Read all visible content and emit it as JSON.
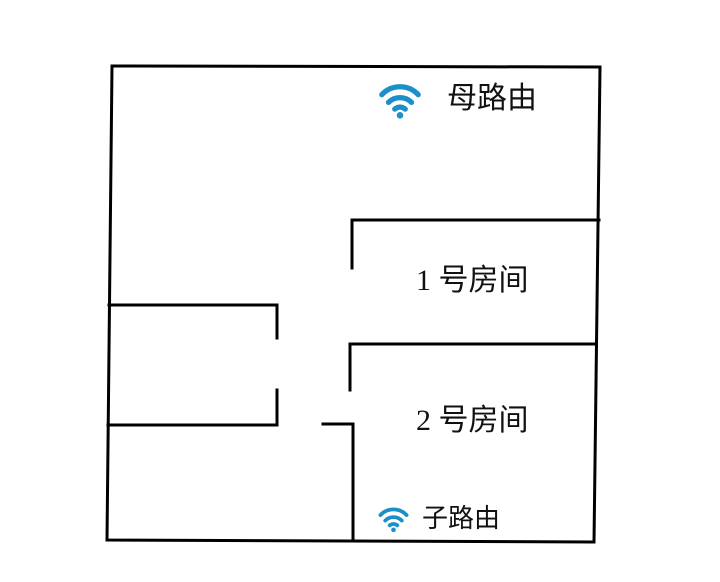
{
  "colors": {
    "wifi_blue": "#1b90c8",
    "wall_black": "#000000",
    "page_bg": "#ffffff"
  },
  "floorplan": {
    "mother_router": {
      "label": "母路由",
      "icon": "wifi-icon"
    },
    "child_router": {
      "label": "子路由",
      "icon": "wifi-icon"
    },
    "rooms": [
      {
        "label": "1 号房间"
      },
      {
        "label": "2 号房间"
      }
    ]
  }
}
